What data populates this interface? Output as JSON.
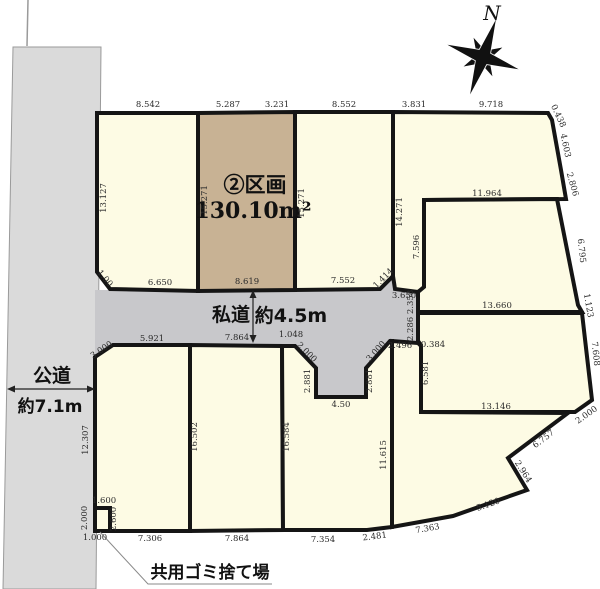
{
  "compass": {
    "label": "N"
  },
  "highlight_parcel": {
    "label": "②区画",
    "area": "130.10m²"
  },
  "private_road": {
    "label": "私道",
    "width": "約4.5m"
  },
  "public_road": {
    "label": "公道",
    "width": "約7.1m"
  },
  "shared_garbage": {
    "label": "共用ゴミ捨て場"
  },
  "colors": {
    "parcel_fill": "#fdfbe4",
    "highlight_fill": "#c8b294",
    "road_fill": "#c8c8cb",
    "public_road_fill": "#dadada",
    "border": "#151515"
  },
  "dimension_labels": [
    {
      "t": "8.542",
      "x": 148,
      "y": 107,
      "r": 0
    },
    {
      "t": "5.287",
      "x": 228,
      "y": 107,
      "r": 0
    },
    {
      "t": "3.231",
      "x": 277,
      "y": 107,
      "r": 0
    },
    {
      "t": "8.552",
      "x": 344,
      "y": 107,
      "r": 0
    },
    {
      "t": "3.831",
      "x": 414,
      "y": 107,
      "r": 0
    },
    {
      "t": "9.718",
      "x": 491,
      "y": 107,
      "r": 0
    },
    {
      "t": "13.127",
      "x": 106,
      "y": 198,
      "r": -90
    },
    {
      "t": "15.271",
      "x": 207,
      "y": 200,
      "r": -90
    },
    {
      "t": "15.271",
      "x": 304,
      "y": 203,
      "r": -90
    },
    {
      "t": "14.271",
      "x": 402,
      "y": 212,
      "r": -90
    },
    {
      "t": "7.596",
      "x": 419,
      "y": 247,
      "r": -90
    },
    {
      "t": "0.438",
      "x": 556,
      "y": 117,
      "r": 65
    },
    {
      "t": "4.603",
      "x": 563,
      "y": 146,
      "r": 78
    },
    {
      "t": "2.806",
      "x": 570,
      "y": 185,
      "r": 74
    },
    {
      "t": "6.795",
      "x": 579,
      "y": 251,
      "r": 84
    },
    {
      "t": "1.123",
      "x": 586,
      "y": 306,
      "r": 80
    },
    {
      "t": "7.608",
      "x": 593,
      "y": 354,
      "r": 84
    },
    {
      "t": "1.00",
      "x": 103,
      "y": 280,
      "r": 50
    },
    {
      "t": "6.650",
      "x": 160,
      "y": 285,
      "r": 0
    },
    {
      "t": "8.619",
      "x": 247,
      "y": 284,
      "r": 0
    },
    {
      "t": "7.552",
      "x": 343,
      "y": 283,
      "r": 0
    },
    {
      "t": "1.414",
      "x": 385,
      "y": 280,
      "r": -45
    },
    {
      "t": "3.650",
      "x": 404,
      "y": 298,
      "r": 0
    },
    {
      "t": "11.964",
      "x": 487,
      "y": 196,
      "r": 0
    },
    {
      "t": "13.660",
      "x": 497,
      "y": 308,
      "r": 0
    },
    {
      "t": "2.358",
      "x": 413,
      "y": 302,
      "r": -90
    },
    {
      "t": "2.286",
      "x": 413,
      "y": 329,
      "r": -90
    },
    {
      "t": "2.496",
      "x": 400,
      "y": 348,
      "r": 0
    },
    {
      "t": "0.384",
      "x": 433,
      "y": 347,
      "r": 0
    },
    {
      "t": "6.581",
      "x": 428,
      "y": 373,
      "r": -90
    },
    {
      "t": "13.146",
      "x": 496,
      "y": 409,
      "r": 0
    },
    {
      "t": "2.000",
      "x": 588,
      "y": 417,
      "r": -35
    },
    {
      "t": "6.757",
      "x": 545,
      "y": 441,
      "r": -37
    },
    {
      "t": "2.964",
      "x": 521,
      "y": 473,
      "r": 58
    },
    {
      "t": "5.120",
      "x": 489,
      "y": 507,
      "r": -19
    },
    {
      "t": "7.363",
      "x": 428,
      "y": 531,
      "r": -10
    },
    {
      "t": "11.615",
      "x": 386,
      "y": 455,
      "r": -90
    },
    {
      "t": "1.048",
      "x": 291,
      "y": 337,
      "r": 0
    },
    {
      "t": "2.000",
      "x": 305,
      "y": 354,
      "r": 45
    },
    {
      "t": "3.000",
      "x": 378,
      "y": 353,
      "r": -48
    },
    {
      "t": "2.881",
      "x": 310,
      "y": 381,
      "r": -90
    },
    {
      "t": "2.881",
      "x": 372,
      "y": 381,
      "r": -90
    },
    {
      "t": "4.50",
      "x": 341,
      "y": 407,
      "r": 0
    },
    {
      "t": "3.000",
      "x": 103,
      "y": 352,
      "r": -34
    },
    {
      "t": "5.921",
      "x": 152,
      "y": 341,
      "r": 0
    },
    {
      "t": "7.864",
      "x": 237,
      "y": 340,
      "r": 0
    },
    {
      "t": "12.307",
      "x": 88,
      "y": 440,
      "r": -90
    },
    {
      "t": "16.502",
      "x": 197,
      "y": 437,
      "r": -90
    },
    {
      "t": "16.584",
      "x": 289,
      "y": 437,
      "r": -90
    },
    {
      "t": "1.600",
      "x": 104,
      "y": 503,
      "r": 0
    },
    {
      "t": "2.000",
      "x": 87,
      "y": 518,
      "r": -90
    },
    {
      "t": "2.600",
      "x": 116,
      "y": 519,
      "r": -90
    },
    {
      "t": "1.000",
      "x": 95,
      "y": 540,
      "r": 0
    },
    {
      "t": "7.306",
      "x": 150,
      "y": 541,
      "r": 0
    },
    {
      "t": "7.864",
      "x": 237,
      "y": 541,
      "r": 0
    },
    {
      "t": "7.354",
      "x": 323,
      "y": 542,
      "r": 0
    },
    {
      "t": "2.481",
      "x": 375,
      "y": 539,
      "r": -7
    }
  ]
}
